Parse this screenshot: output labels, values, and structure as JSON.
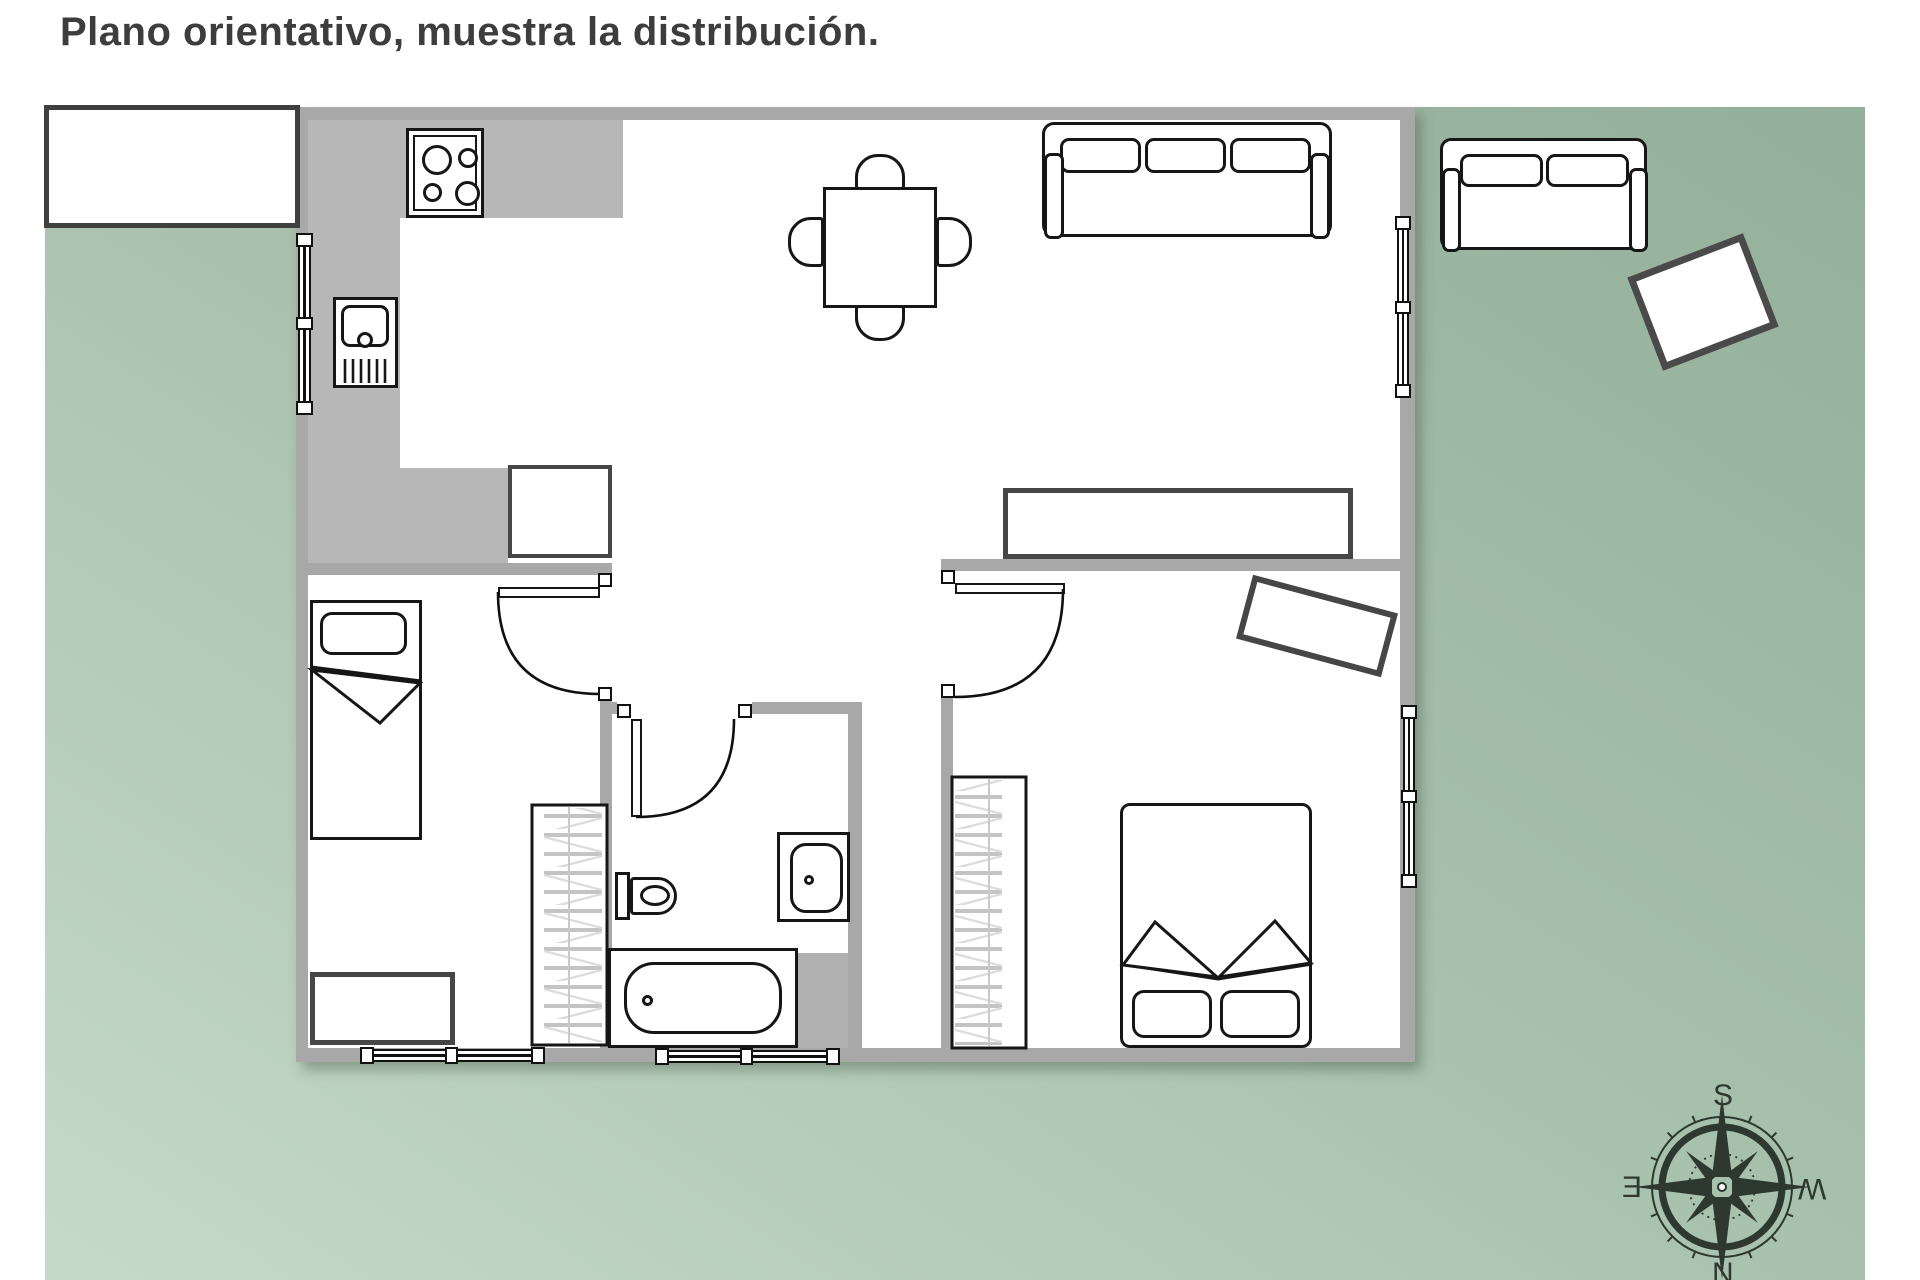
{
  "title": "Plano orientativo, muestra la distribución.",
  "compass": {
    "label_top": "S",
    "label_right": "W",
    "label_bottom": "N",
    "label_left": "E"
  },
  "colors": {
    "terrace_green_dark": "#93b09b",
    "terrace_green_light": "#c6dac8",
    "wall_gray": "#a8a8a8",
    "counter_gray": "#b7b7b7",
    "furniture_stroke": "#161616",
    "box_furniture_stroke": "#464646",
    "title_text": "#3d3d3d",
    "compass_ink": "#2d382e"
  },
  "plan": {
    "rooms": [
      {
        "name": "kitchen",
        "items": [
          "hob-4-burners",
          "sink-unit",
          "l-shaped-counter",
          "fridge",
          "window"
        ]
      },
      {
        "name": "living-dining",
        "items": [
          "dining-table",
          "four-chairs",
          "sofa-3-seat",
          "sideboard",
          "window"
        ]
      },
      {
        "name": "bedroom-1",
        "items": [
          "single-bed",
          "wardrobe",
          "dresser",
          "door",
          "double-window"
        ]
      },
      {
        "name": "bathroom",
        "items": [
          "toilet",
          "washbasin",
          "bathtub",
          "door",
          "double-window"
        ]
      },
      {
        "name": "bedroom-2",
        "items": [
          "double-bed",
          "wardrobe",
          "tilted-desk",
          "door",
          "window"
        ]
      },
      {
        "name": "terrace",
        "items": [
          "rect-table",
          "sofa-2-seat",
          "tilted-side-table",
          "compass-rose"
        ]
      }
    ]
  }
}
